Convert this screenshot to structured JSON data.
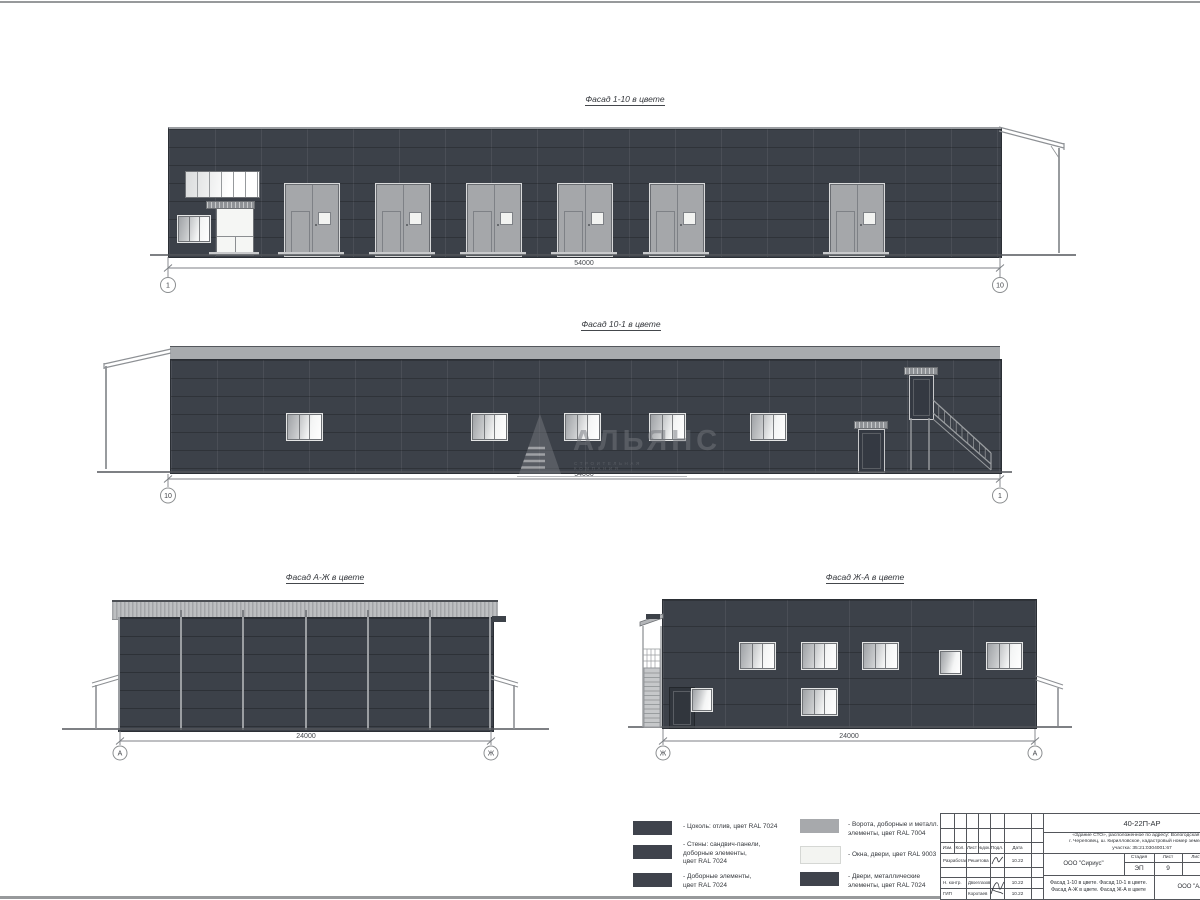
{
  "facade1": {
    "title": "Фасад 1-10 в цвете",
    "dim": "54000",
    "axis_left": "1",
    "axis_right": "10"
  },
  "facade2": {
    "title": "Фасад 10-1 в цвете",
    "dim": "54000",
    "axis_left": "10",
    "axis_right": "1"
  },
  "facade3": {
    "title": "Фасад А-Ж в цвете",
    "dim": "24000",
    "axis_left": "А",
    "axis_right": "Ж"
  },
  "facade4": {
    "title": "Фасад Ж-А в цвете",
    "dim": "24000",
    "axis_left": "Ж",
    "axis_right": "А"
  },
  "watermark": {
    "name": "АЛЬЯНС",
    "subtitle": "СТРОИТЕЛЬНАЯ КОМПАНИЯ"
  },
  "legend": {
    "items": [
      {
        "label": "- Цоколь: отлив, цвет RAL 7024",
        "swatch": "#3F434C"
      },
      {
        "label": "- Стены: сандвич-панели,\nдоборные элементы,\nцвет RAL 7024",
        "swatch": "#3F434C"
      },
      {
        "label": "- Доборные элементы,\nцвет RAL 7024",
        "swatch": "#3F434C"
      },
      {
        "label": "- Ворота, доборные и металл.\nэлементы, цвет RAL 7004",
        "swatch": "#A7A9AC"
      },
      {
        "label": "- Окна, двери, цвет RAL 9003",
        "swatch": "#F3F4F1"
      },
      {
        "label": "- Двери, металлические\nэлементы, цвет RAL 7024",
        "swatch": "#3F434C"
      }
    ]
  },
  "titleblock": {
    "doc_number": "40-22П-АР",
    "project_line1": "«Здание СТО», расположенное по адресу: Вологодская обл.,",
    "project_line2": "г. Череповец, ш. Кирилловское, кадастровый номер земельного",
    "project_line3": "участка: 35:21:0304001:67",
    "col_izm": "Изм.",
    "col_kol": "Кол.",
    "col_list": "Лист",
    "col_ndok": "№док.",
    "col_podl": "Подл.",
    "col_data": "Дата",
    "rows": [
      {
        "role": "Разработал",
        "name": "Решетова",
        "date": "10.22"
      },
      {
        "role": "Н. контр.",
        "name": "Двоеглазов",
        "date": "10.22"
      },
      {
        "role": "ГИП",
        "name": "Коротаев",
        "date": "10.22"
      }
    ],
    "company": "ООО \"Сириус\"",
    "stage_label": "Стадия",
    "sheet_label": "Лист",
    "sheets_label": "Листов",
    "stage": "ЭП",
    "sheet": "9",
    "sheet_title_line1": "Фасад 1-10 в цвете. Фасад 10-1 в цвете.",
    "sheet_title_line2": "Фасад А-Ж в цвете. Фасад Ж-А в цвете",
    "contractor": "ООО \"Альянс\""
  },
  "colors": {
    "wall": "#3C4149",
    "gate": "#A5A7AA",
    "band": "#A8ABAE",
    "window": "#F5F6F4",
    "ground": "#53565B"
  }
}
